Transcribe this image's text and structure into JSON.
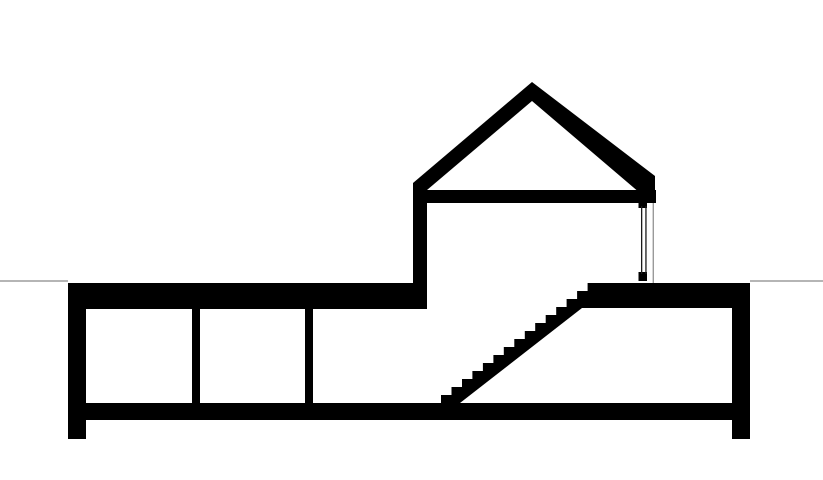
{
  "app": {
    "name": "architectural-section-drawing",
    "description": "Black and white architectural cross-section: house with gabled roof above ground, sunken lower level with two partition walls, and a straight staircase rising to an upper slab; light gray ground line at grade"
  },
  "canvas": {
    "width": 823,
    "height": 480,
    "background": "#ffffff"
  },
  "colors": {
    "ink": "#000000",
    "ground": "#b5b5b5",
    "glazing": "#1a1a1a",
    "frame": "#9a9a9a"
  },
  "shapes": [
    {
      "name": "ground-line-left",
      "type": "rect",
      "color": "ground",
      "x": 0,
      "y": 280,
      "w": 68,
      "h": 2
    },
    {
      "name": "ground-line-right",
      "type": "rect",
      "color": "ground",
      "x": 750,
      "y": 280,
      "w": 73,
      "h": 2
    },
    {
      "name": "roof-left-slope",
      "type": "polygon",
      "color": "ink",
      "points": [
        [
          413,
          183
        ],
        [
          532,
          82
        ],
        [
          532,
          101
        ],
        [
          427,
          190
        ],
        [
          413,
          190
        ]
      ]
    },
    {
      "name": "roof-right-slope",
      "type": "polygon",
      "color": "ink",
      "points": [
        [
          532,
          82
        ],
        [
          655,
          176
        ],
        [
          655,
          203
        ],
        [
          640,
          203
        ],
        [
          640,
          193
        ],
        [
          532,
          101
        ]
      ]
    },
    {
      "name": "attic-tie-beam",
      "type": "rect",
      "color": "ink",
      "x": 413,
      "y": 190,
      "w": 243,
      "h": 13
    },
    {
      "name": "upper-floor-left-wall",
      "type": "rect",
      "color": "ink",
      "x": 413,
      "y": 183,
      "w": 14,
      "h": 100
    },
    {
      "name": "window-head-frame",
      "type": "rect",
      "color": "ink",
      "x": 638.5,
      "y": 203,
      "w": 8.5,
      "h": 5
    },
    {
      "name": "window-sill-frame",
      "type": "rect",
      "color": "ink",
      "x": 638.5,
      "y": 272,
      "w": 8.5,
      "h": 9
    },
    {
      "name": "window-glazing-line-inner",
      "type": "rect",
      "color": "glazing",
      "x": 641,
      "y": 206,
      "w": 1.3,
      "h": 68
    },
    {
      "name": "window-glazing-line-outer",
      "type": "rect",
      "color": "glazing",
      "x": 645.3,
      "y": 206,
      "w": 1.3,
      "h": 68
    },
    {
      "name": "window-jamb-line",
      "type": "rect",
      "color": "frame",
      "x": 652.6,
      "y": 203,
      "w": 1.4,
      "h": 80
    },
    {
      "name": "basement-top-slab-left",
      "type": "rect",
      "color": "ink",
      "x": 68,
      "y": 283,
      "w": 359,
      "h": 26
    },
    {
      "name": "basement-top-slab-right",
      "type": "rect",
      "color": "ink",
      "x": 598,
      "y": 283,
      "w": 152,
      "h": 25
    },
    {
      "name": "basement-left-wall",
      "type": "rect",
      "color": "ink",
      "x": 68,
      "y": 283,
      "w": 18,
      "h": 156
    },
    {
      "name": "basement-right-wall",
      "type": "rect",
      "color": "ink",
      "x": 732,
      "y": 283,
      "w": 18,
      "h": 156
    },
    {
      "name": "basement-floor-slab",
      "type": "rect",
      "color": "ink",
      "x": 68,
      "y": 403,
      "w": 682,
      "h": 17
    },
    {
      "name": "basement-partition-wall-1",
      "type": "rect",
      "color": "ink",
      "x": 192,
      "y": 309,
      "w": 8,
      "h": 94
    },
    {
      "name": "basement-partition-wall-2",
      "type": "rect",
      "color": "ink",
      "x": 305,
      "y": 309,
      "w": 8,
      "h": 94
    },
    {
      "name": "staircase",
      "type": "polygon",
      "color": "ink",
      "points": [
        [
          441,
          403
        ],
        [
          441,
          395
        ],
        [
          451.5,
          395
        ],
        [
          451.5,
          387
        ],
        [
          462,
          387
        ],
        [
          462,
          379
        ],
        [
          472.4,
          379
        ],
        [
          472.4,
          371
        ],
        [
          482.9,
          371
        ],
        [
          482.9,
          363
        ],
        [
          493.4,
          363
        ],
        [
          493.4,
          355
        ],
        [
          503.8,
          355
        ],
        [
          503.8,
          347
        ],
        [
          514.3,
          347
        ],
        [
          514.3,
          339
        ],
        [
          524.8,
          339
        ],
        [
          524.8,
          331
        ],
        [
          535.2,
          331
        ],
        [
          535.2,
          323
        ],
        [
          545.7,
          323
        ],
        [
          545.7,
          315
        ],
        [
          556.2,
          315
        ],
        [
          556.2,
          307
        ],
        [
          566.6,
          307
        ],
        [
          566.6,
          299
        ],
        [
          577.1,
          299
        ],
        [
          577.1,
          291
        ],
        [
          587.6,
          291
        ],
        [
          587.6,
          283
        ],
        [
          598,
          283
        ],
        [
          598,
          308
        ],
        [
          582,
          308
        ],
        [
          460,
          403
        ]
      ]
    }
  ]
}
